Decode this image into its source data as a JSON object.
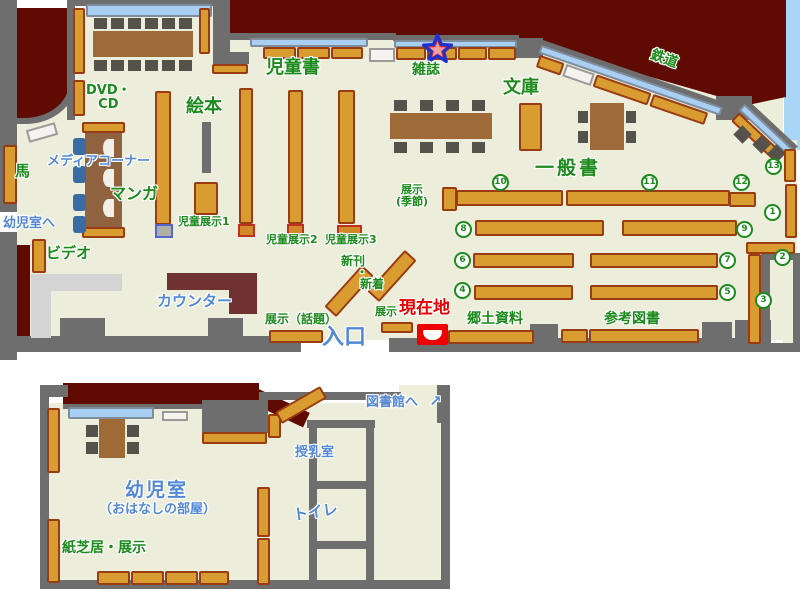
{
  "colors": {
    "floor": "#EDEDDC",
    "wall_gray": "#6E6E6E",
    "outside_red": "#5F0B04",
    "shelf_fill": "#D99C31",
    "shelf_border": "#9A3C12",
    "window_blue": "#A9CFF2",
    "sky_blue": "#A9D6F7",
    "counter_maroon": "#6F3231",
    "table_brown": "#9E6B38",
    "chair_dark": "#54524A",
    "chair_blue": "#3A6BA3",
    "label_green": "#1C8A1C",
    "label_blue": "#5388D5",
    "label_red": "#E60000"
  },
  "main_floor": {
    "areas": {
      "jidosho": "児童書",
      "zasshi": "雑誌",
      "bunko": "文庫",
      "tetsudo": "鉄道",
      "ippansho": "一般書",
      "ehon": "絵本",
      "dvd_cd": "DVD・\nCD",
      "media_corner": "メディアコーナー",
      "manga": "マンガ",
      "uma": "馬",
      "video": "ビデオ",
      "counter": "カウンター",
      "kyodo_shiryo": "郷土資料",
      "sanko_tosho": "参考図書"
    },
    "displays": {
      "jido_tenji1": "児童展示1",
      "jido_tenji2": "児童展示2",
      "jido_tenji3": "児童展示3",
      "shinkan": "新刊",
      "dot": "・",
      "shinchaku": "新着",
      "tenji_wadai": "展示（話題）",
      "tenji_kisetsu": "展示\n(季節)",
      "tenji": "展示"
    },
    "markers": {
      "genzaichi": "現在地",
      "iriguchi": "入口",
      "yojishitsu_e": "幼児室へ"
    },
    "shelf_numbers": {
      "n1": "1",
      "n2": "2",
      "n3": "3",
      "n4": "4",
      "n5": "5",
      "n6": "6",
      "n7": "7",
      "n8": "8",
      "n9": "9",
      "n10": "10",
      "n11": "11",
      "n12": "12",
      "n13": "13"
    }
  },
  "kids_floor": {
    "labels": {
      "yojishitsu": "幼児室",
      "ohanashi": "（おはなしの部屋）",
      "kamishibai": "紙芝居・展示",
      "junyushitsu": "授乳室",
      "toire": "トイレ",
      "toshokan_e": "図書館へ",
      "arrow": "↗"
    }
  }
}
